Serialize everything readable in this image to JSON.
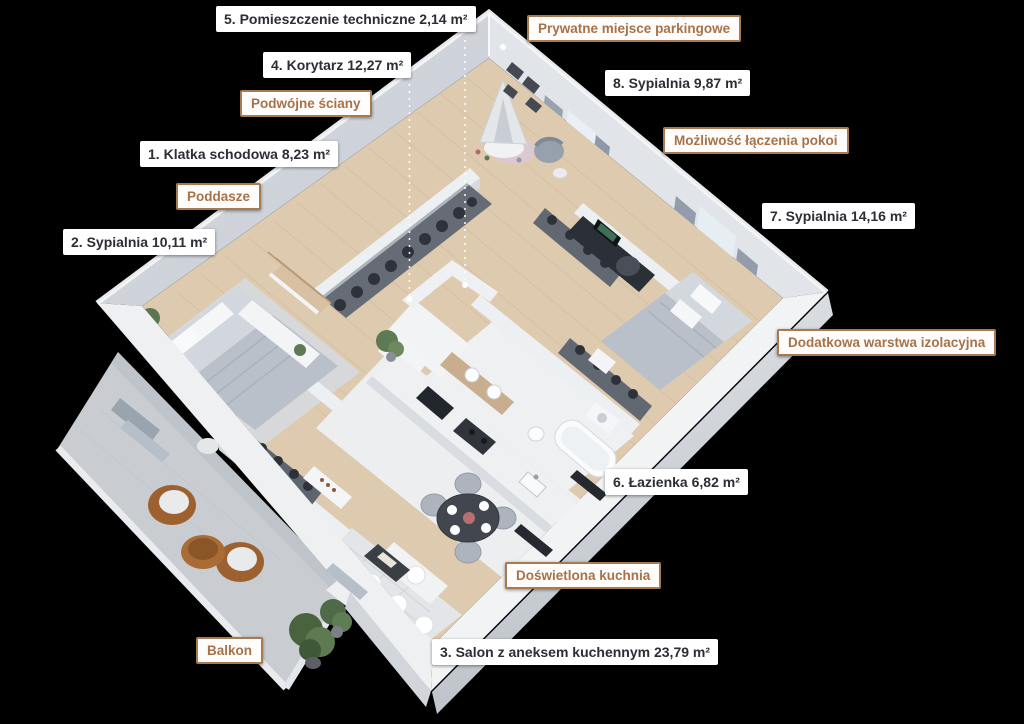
{
  "room_labels": [
    {
      "number": "1.",
      "text": "Klatka schodowa 8,23 m²"
    },
    {
      "number": "2.",
      "text": "Sypialnia 10,11 m²"
    },
    {
      "number": "3.",
      "text": "Salon z aneksem kuchennym 23,79 m²"
    },
    {
      "number": "4.",
      "text": "Korytarz 12,27 m²"
    },
    {
      "number": "5.",
      "text": "Pomieszczenie techniczne 2,14 m²"
    },
    {
      "number": "6.",
      "text": "Łazienka 6,82 m²"
    },
    {
      "number": "7.",
      "text": "Sypialnia 14,16 m²"
    },
    {
      "number": "8.",
      "text": "Sypialnia 9,87 m²"
    }
  ],
  "feature_tags": [
    "Prywatne miejsce parkingowe",
    "Podwójne ściany",
    "Poddasze",
    "Możliwość łączenia pokoi",
    "Dodatkowa warstwa izolacyjna",
    "Doświetlona kuchnia",
    "Balkon"
  ],
  "colors": {
    "background": "#000000",
    "label_bg": "#ffffff",
    "label_text": "#2d2d35",
    "tag_border": "#a87a52",
    "tag_text": "#a5724a",
    "wood_floor": "#decaaf",
    "tile_floor": "#edeff1",
    "wall_white": "#f2f3f5",
    "balcony_concrete": "#c9cdd2",
    "rattan_brown": "#9d6130"
  }
}
